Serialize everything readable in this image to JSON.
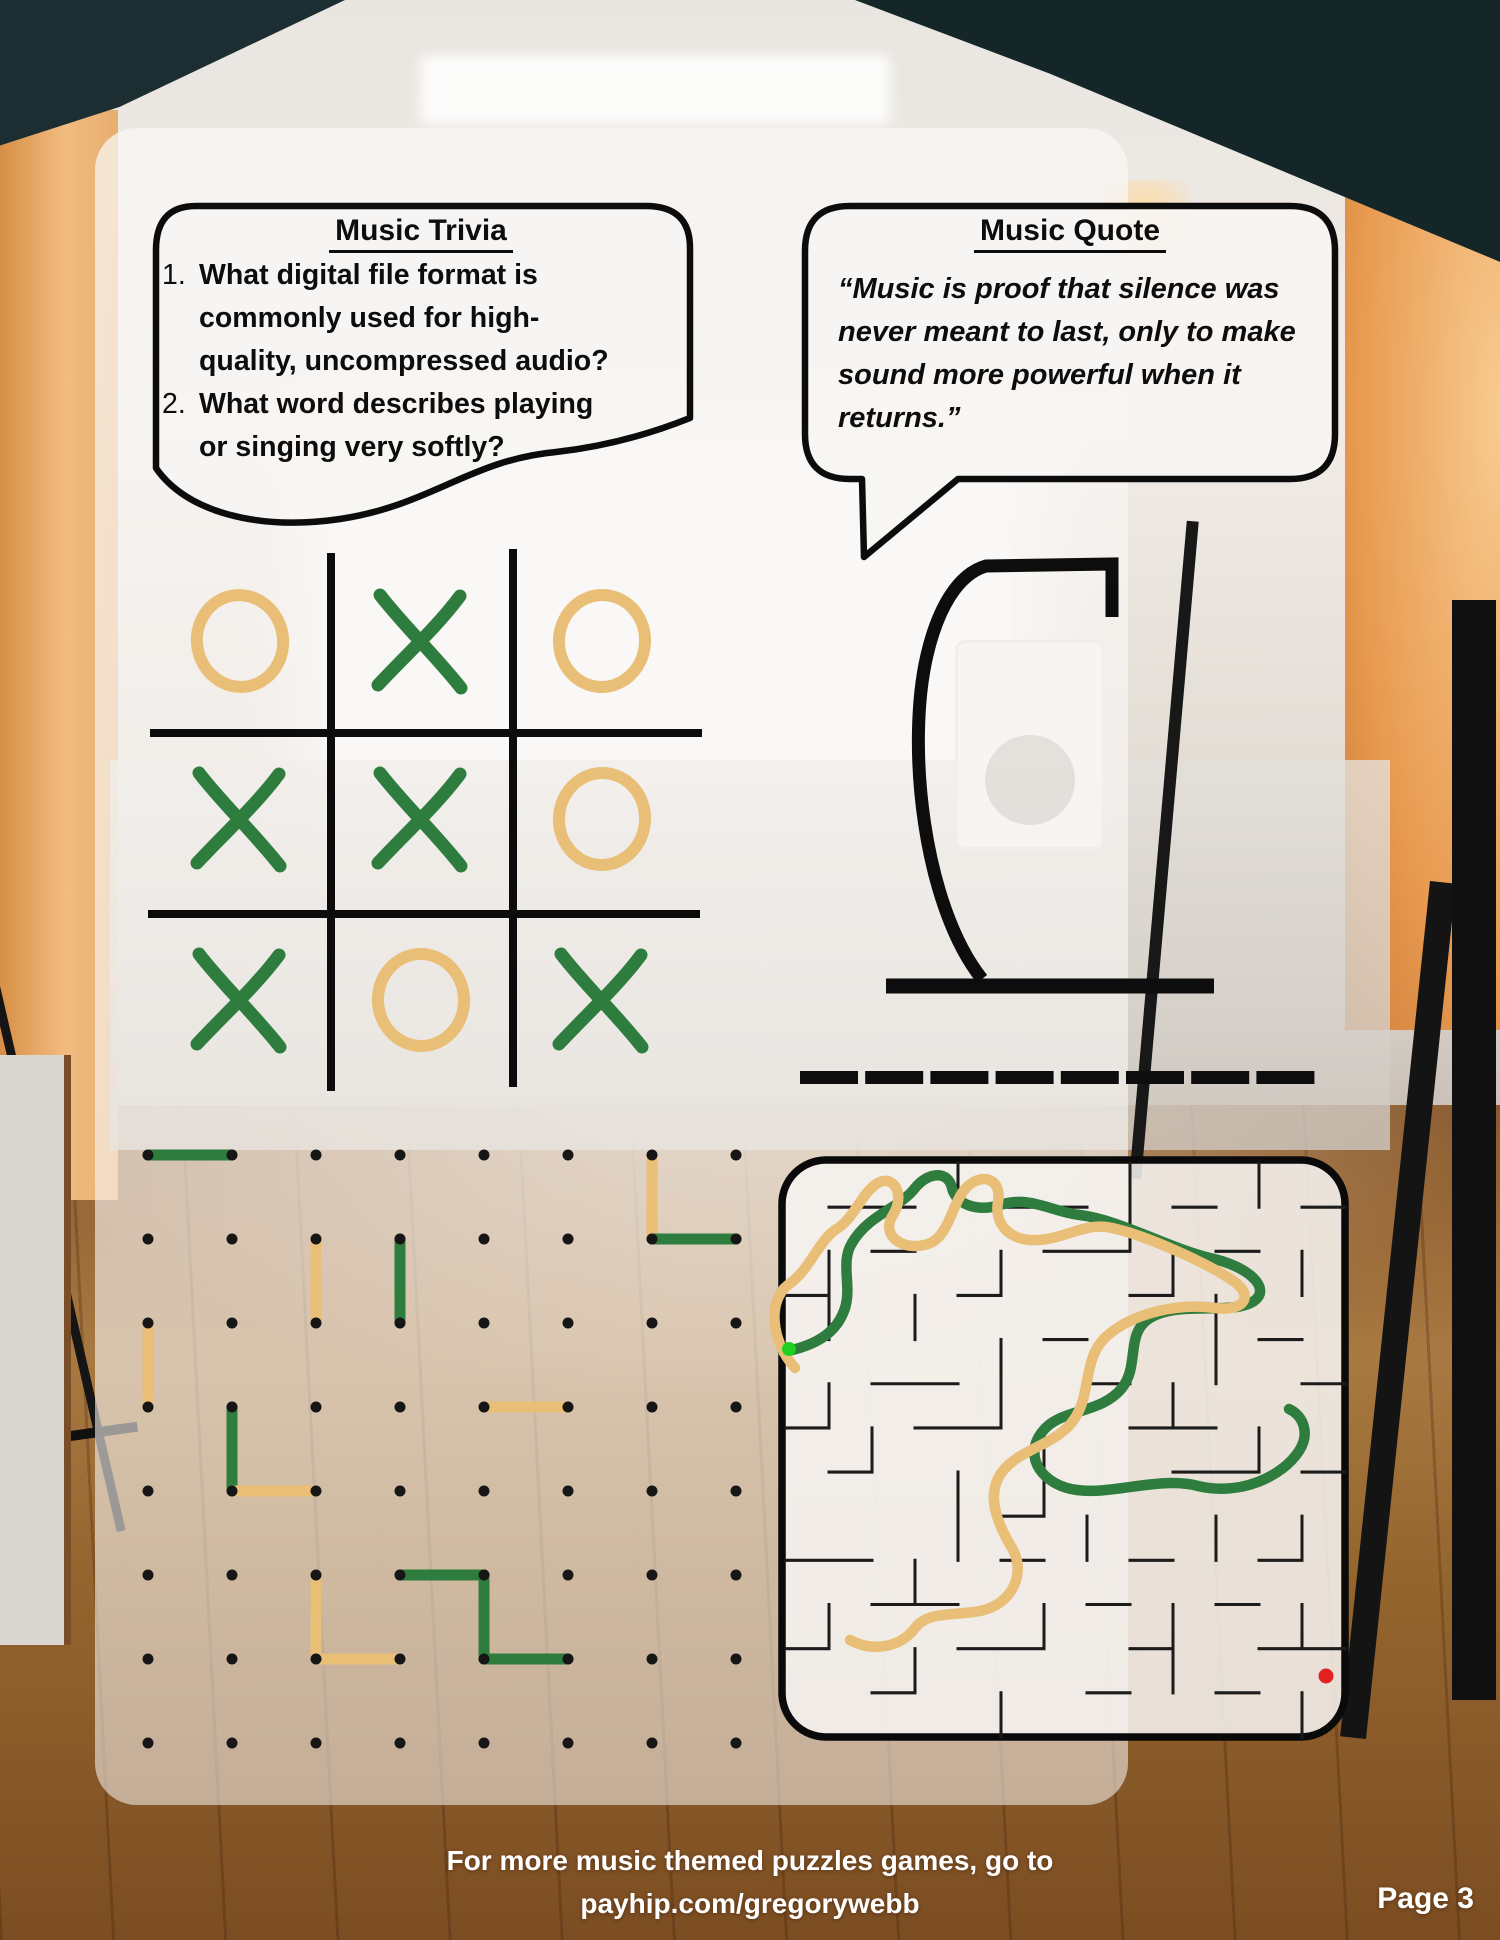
{
  "page": {
    "footer_line1": "For more music themed puzzles games, go to",
    "footer_line2": "payhip.com/gregorywebb",
    "page_number": "Page 3"
  },
  "trivia": {
    "title": "Music Trivia",
    "questions": [
      "What digital file format is commonly used for high-quality, uncompressed audio?",
      "What word describes playing or singing very softly?"
    ]
  },
  "quote": {
    "title": "Music Quote",
    "text": "“Music is proof that silence was never meant to last, only to make sound more powerful when it returns.”"
  },
  "tic_tac_toe": {
    "board": [
      [
        "O",
        "X",
        "O"
      ],
      [
        "X",
        "X",
        "O"
      ],
      [
        "X",
        "O",
        "X"
      ]
    ]
  },
  "hangman": {
    "blanks": 8,
    "gallows_path": "M982 979 C923 905 906 745 927 655 C938 608 958 574 986 566 L1112 564 L1112 617",
    "base_path": "M886 986 L1214 986"
  },
  "dots_and_boxes": {
    "rows": 8,
    "cols": 8,
    "lines": [
      {
        "player": "green",
        "from": [
          0,
          0
        ],
        "to": [
          1,
          0
        ]
      },
      {
        "player": "yellow",
        "from": [
          2,
          1
        ],
        "to": [
          2,
          2
        ]
      },
      {
        "player": "green",
        "from": [
          3,
          1
        ],
        "to": [
          3,
          2
        ]
      },
      {
        "player": "yellow",
        "from": [
          0,
          2
        ],
        "to": [
          0,
          3
        ]
      },
      {
        "player": "green",
        "from": [
          1,
          3
        ],
        "to": [
          1,
          4
        ]
      },
      {
        "player": "yellow",
        "from": [
          1,
          4
        ],
        "to": [
          2,
          4
        ]
      },
      {
        "player": "yellow",
        "from": [
          4,
          3
        ],
        "to": [
          5,
          3
        ]
      },
      {
        "player": "yellow",
        "from": [
          2,
          5
        ],
        "to": [
          2,
          6
        ]
      },
      {
        "player": "yellow",
        "from": [
          2,
          6
        ],
        "to": [
          3,
          6
        ]
      },
      {
        "player": "green",
        "from": [
          3,
          5
        ],
        "to": [
          4,
          5
        ]
      },
      {
        "player": "green",
        "from": [
          4,
          5
        ],
        "to": [
          4,
          6
        ]
      },
      {
        "player": "green",
        "from": [
          4,
          6
        ],
        "to": [
          5,
          6
        ]
      },
      {
        "player": "yellow",
        "from": [
          6,
          0
        ],
        "to": [
          6,
          1
        ]
      },
      {
        "player": "green",
        "from": [
          6,
          1
        ],
        "to": [
          7,
          1
        ]
      }
    ]
  },
  "maze": {
    "grid": 13,
    "walls_path": "M1 1 H3 M4 0 V1 M5 1 H7 M8 0 V2 M9 1 H10 M11 0 V1 M12 1 H13 M1 2 V4 M2 2 H3 M3 3 V4 M5 2 V3 M6 2 H8 M9 2 V3 M10 2 H11 M12 2 V3 M0 3 H1 M4 3 H5 M6 4 H7 M8 3 H9 M10 3 V5 M11 4 H12 M1 5 V6 M2 5 H4 M5 4 V6 M7 5 H8 M9 5 V6 M12 5 H13 M0 6 H1 M2 6 V7 M3 6 H5 M6 6 V8 M8 6 H10 M11 6 V7 M12 7 H13 M1 7 H2 M4 7 V9 M5 8 H6 M7 8 V9 M9 7 H11 M10 8 V9 M12 8 V9 M0 9 H2 M3 9 V10 M5 9 H6 M8 9 H9 M11 9 H12 M1 10 V11 M2 10 H4 M6 10 V11 M7 10 H8 M9 10 V12 M10 10 H11 M12 10 V11 M0 11 H1 M3 11 V12 M4 11 H6 M8 11 H9 M11 11 H13 M2 12 H3 M5 12 V13 M7 12 H8 M10 12 H11 M12 12 V13",
    "path_green": "M783 1352 C820 1345 838 1330 845 1308 C852 1286 840 1262 852 1243 C868 1215 900 1208 915 1188 C928 1172 948 1170 952 1188 C956 1205 978 1212 1000 1205 C1030 1195 1052 1212 1080 1215 C1120 1220 1168 1248 1210 1258 C1248 1266 1272 1288 1254 1301 C1232 1316 1180 1300 1150 1318 C1125 1333 1140 1365 1122 1388 C1100 1415 1060 1408 1042 1432 C1022 1458 1044 1486 1077 1490 C1112 1495 1160 1476 1198 1486 C1240 1496 1282 1477 1299 1451 C1310 1434 1304 1416 1289 1409",
    "path_yellow": "M795 1368 C770 1340 768 1300 788 1285 C812 1268 818 1240 838 1228 C855 1217 862 1192 878 1183 C895 1174 905 1196 893 1215 C880 1235 902 1252 928 1244 C950 1237 952 1200 968 1186 C984 1172 1002 1180 998 1202 C994 1224 1010 1242 1038 1240 C1068 1238 1085 1222 1112 1228 C1145 1235 1205 1262 1232 1280 C1255 1295 1245 1312 1215 1308 C1180 1303 1135 1312 1108 1335 C1082 1357 1092 1392 1075 1418 C1058 1445 1020 1448 1002 1472 C985 1495 998 1525 1012 1548 C1025 1570 1015 1598 990 1608 C965 1618 930 1608 915 1628 C900 1648 872 1652 850 1640"
  },
  "colors": {
    "marker_green": "#2f7d3e",
    "marker_yellow": "#e9be77",
    "ink_black": "#0d0d0d",
    "maze_start_green": "#1ed11e",
    "maze_end_red": "#e32120"
  }
}
